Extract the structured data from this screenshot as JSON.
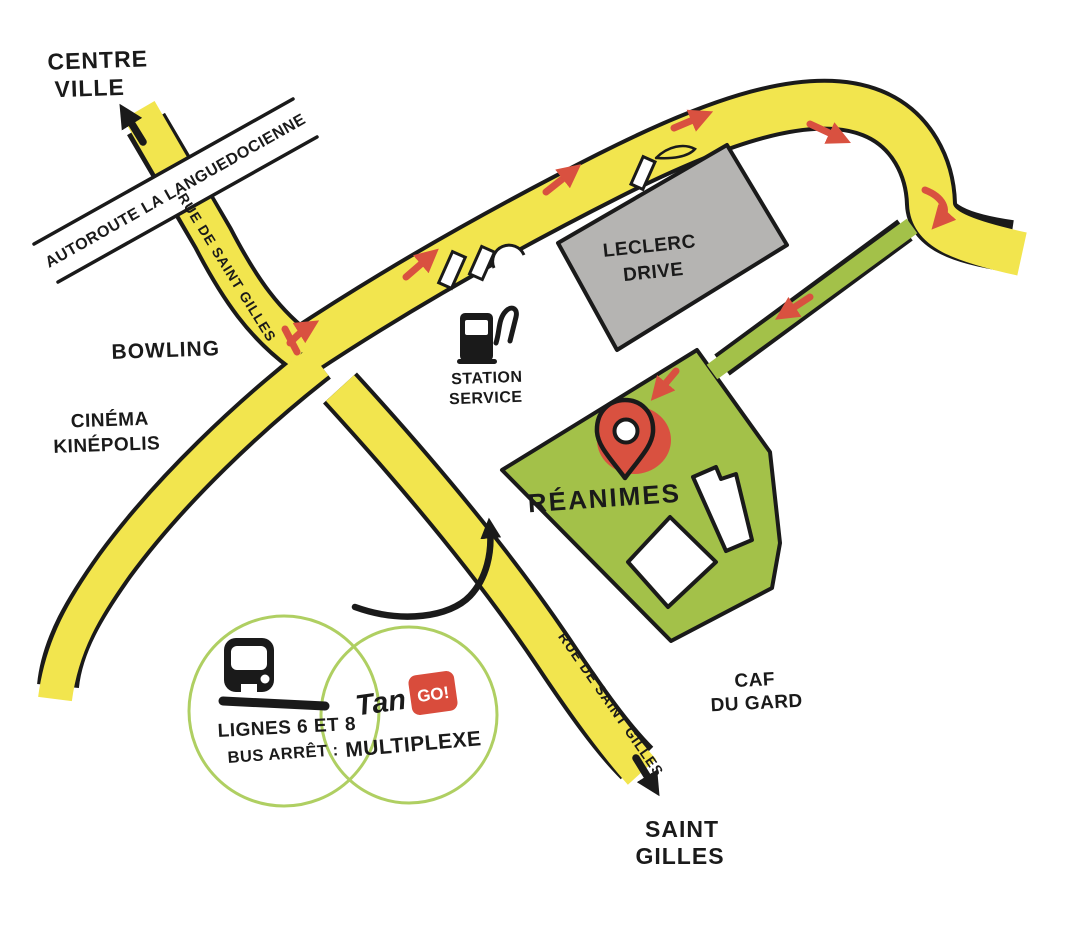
{
  "map": {
    "labels": {
      "centre_ville_line1": "CENTRE",
      "centre_ville_line2": "VILLE",
      "autoroute": "AUTOROUTE LA LANGUEDOCIENNE",
      "rue_saint_gilles_upper": "RUE DE SAINT GILLES",
      "rue_saint_gilles_lower": "RUE DE SAINT GILLES",
      "bowling": "BOWLING",
      "cinema_line1": "CINÉMA",
      "cinema_line2": "KINÉPOLIS",
      "leclerc_line1": "LECLERC",
      "leclerc_line2": "DRIVE",
      "station_line1": "STATION",
      "station_line2": "SERVICE",
      "reanimes": "RÉANIMES",
      "caf_line1": "CAF",
      "caf_line2": "DU GARD",
      "saint_gilles_line1": "SAINT",
      "saint_gilles_line2": "GILLES"
    },
    "bus_info": {
      "lines": "LIGNES 6 ET 8",
      "stop_prefix": "BUS ARRÊT :",
      "stop_name": "MULTIPLEXE",
      "brand_tan": "Tan",
      "brand_go": "GO!"
    },
    "colors": {
      "road_yellow": "#F2E54E",
      "zone_green": "#A3C149",
      "building_gray": "#B5B4B2",
      "arrow_red": "#D95140",
      "ink": "#1A1A1A",
      "tango_blue": "#2E7FC0",
      "tango_red": "#D94C3C",
      "bubble_outline": "#AFCF62"
    },
    "icons": {
      "destination": "location-pin-icon",
      "fuel": "fuel-pump-icon",
      "bus": "bus-front-icon",
      "to_centre_ville": "arrow-up-left-icon",
      "to_saint_gilles": "arrow-down-right-icon",
      "route_hint": "curved-arrow-icon"
    }
  }
}
